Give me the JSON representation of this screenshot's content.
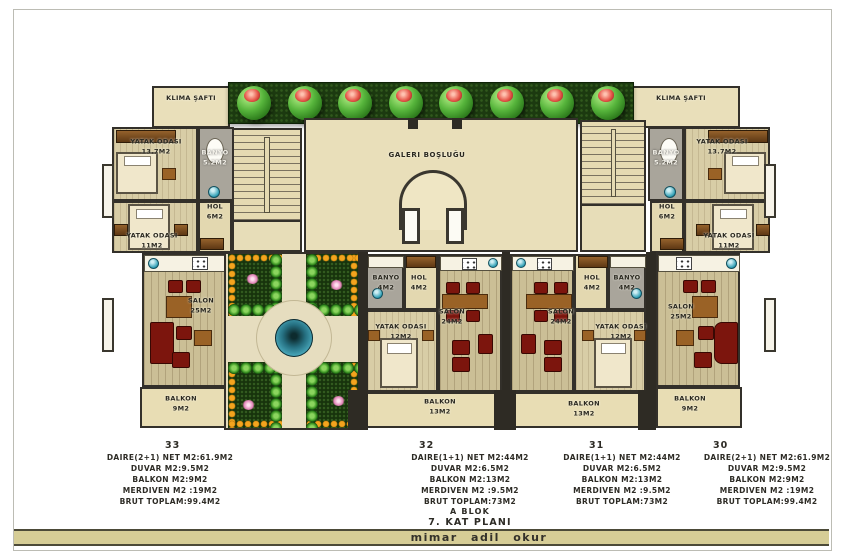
{
  "labels": {
    "klima_left": "KLIMA ŞAFTI",
    "klima_right": "KLIMA ŞAFTI",
    "galeri": "GALERI BOŞLUĞU"
  },
  "rooms": {
    "yatak_l1": {
      "name": "YATAK ODASI",
      "area": "13.7M2"
    },
    "banyo_l": {
      "name": "BANYO",
      "area": "5.2M2"
    },
    "yatak_l2": {
      "name": "YATAK ODASI",
      "area": "11M2"
    },
    "hol_l": {
      "name": "HOL",
      "area": "6M2"
    },
    "salon_l": {
      "name": "SALON",
      "area": "25M2"
    },
    "balkon_l": {
      "name": "BALKON",
      "area": "9M2"
    },
    "banyo_32": {
      "name": "BANYO",
      "area": "4M2"
    },
    "hol_32": {
      "name": "HOL",
      "area": "4M2"
    },
    "yatak_32": {
      "name": "YATAK ODASI",
      "area": "12M2"
    },
    "salon_32": {
      "name": "SALON",
      "area": "24M2"
    },
    "balkon_32": {
      "name": "BALKON",
      "area": "13M2"
    },
    "salon_31": {
      "name": "SALON",
      "area": "24M2"
    },
    "hol_31": {
      "name": "HOL",
      "area": "4M2"
    },
    "banyo_31": {
      "name": "BANYO",
      "area": "4M2"
    },
    "yatak_31": {
      "name": "YATAK ODASI",
      "area": "12M2"
    },
    "balkon_31": {
      "name": "BALKON",
      "area": "13M2"
    },
    "banyo_r": {
      "name": "BANYO",
      "area": "5.2M2"
    },
    "yatak_r1": {
      "name": "YATAK ODASI",
      "area": "13.7M2"
    },
    "yatak_r2": {
      "name": "YATAK ODASI",
      "area": "11M2"
    },
    "hol_r": {
      "name": "HOL",
      "area": "6M2"
    },
    "salon_r": {
      "name": "SALON",
      "area": "25M2"
    },
    "balkon_r": {
      "name": "BALKON",
      "area": "9M2"
    }
  },
  "units": [
    {
      "no": "33",
      "lines": [
        "DAIRE(2+1) NET M2:61.9M2",
        "DUVAR M2:9.5M2",
        "BALKON M2:9M2",
        "MERDIVEN M2 :19M2",
        "BRUT TOPLAM:99.4M2"
      ]
    },
    {
      "no": "32",
      "lines": [
        "DAIRE(1+1) NET M2:44M2",
        "DUVAR M2:6.5M2",
        "BALKON M2:13M2",
        "MERDIVEN M2 :9.5M2",
        "BRUT TOPLAM:73M2"
      ]
    },
    {
      "no": "31",
      "lines": [
        "DAIRE(1+1) NET M2:44M2",
        "DUVAR M2:6.5M2",
        "BALKON M2:13M2",
        "MERDIVEN M2 :9.5M2",
        "BRUT TOPLAM:73M2"
      ]
    },
    {
      "no": "30",
      "lines": [
        "DAIRE(2+1) NET M2:61.9M2",
        "DUVAR M2:9.5M2",
        "BALKON M2:9M2",
        "MERDIVEN M2 :19M2",
        "BRUT TOPLAM:99.4M2"
      ]
    }
  ],
  "plan_title": {
    "block": "A BLOK",
    "floor": "7. KAT PLANI"
  },
  "page": {
    "architect": "mimar adil okur"
  },
  "colors": {
    "wall": "#33302a",
    "hedge": "#1c3a10",
    "orange_dot": "#f4a41e",
    "pond": "#48a7ba",
    "bar": "#d6cd96",
    "maroon": "#7c150d"
  }
}
